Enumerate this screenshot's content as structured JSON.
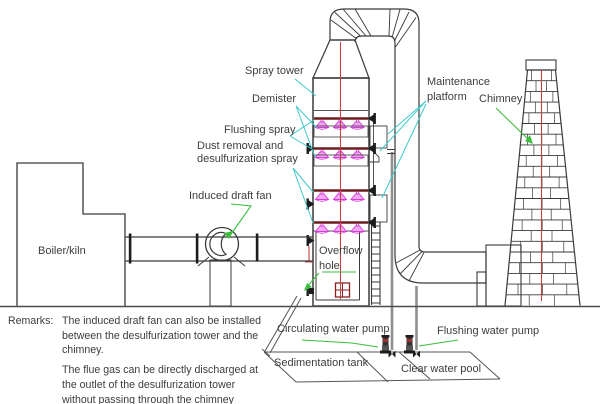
{
  "labels": {
    "spray_tower": "Spray tower",
    "demister": "Demister",
    "flushing_spray": "Flushing spray",
    "dust_removal": [
      "Dust removal and",
      "desulfurization spray"
    ],
    "induced_draft_fan": "Induced draft fan",
    "maintenance_platform": [
      "Maintenance",
      "platform"
    ],
    "chimney": "Chimney",
    "boiler_kiln": "Boiler/kiln",
    "overflow_hole": [
      "Overflow",
      "hole"
    ],
    "circulating_water_pump": "Circulating water pump",
    "flushing_water_pump": "Flushing water pump",
    "sedimentation_tank": "Sedimentation tank",
    "clear_water_pool": "Clear water pool"
  },
  "remarks": {
    "label": "Remarks:",
    "para1": [
      "The induced draft fan can also be installed",
      "between the desulfurization tower and the",
      "chimney."
    ],
    "para2": [
      "The flue gas can be directly discharged at",
      "the outlet of the desulfurization tower",
      "without passing through the chimney"
    ]
  },
  "colors": {
    "line_dark": "#3a3a3a",
    "text_gray": "#3d3d3d",
    "leader_cyan": "#3fc9c9",
    "leader_green": "#3cbe3c",
    "centerline_red": "#c54242",
    "spray_header_maroon": "#6e1d1d",
    "nozzle_magenta": "#d83cd8",
    "nozzle_fill": "#f2aaf2"
  }
}
